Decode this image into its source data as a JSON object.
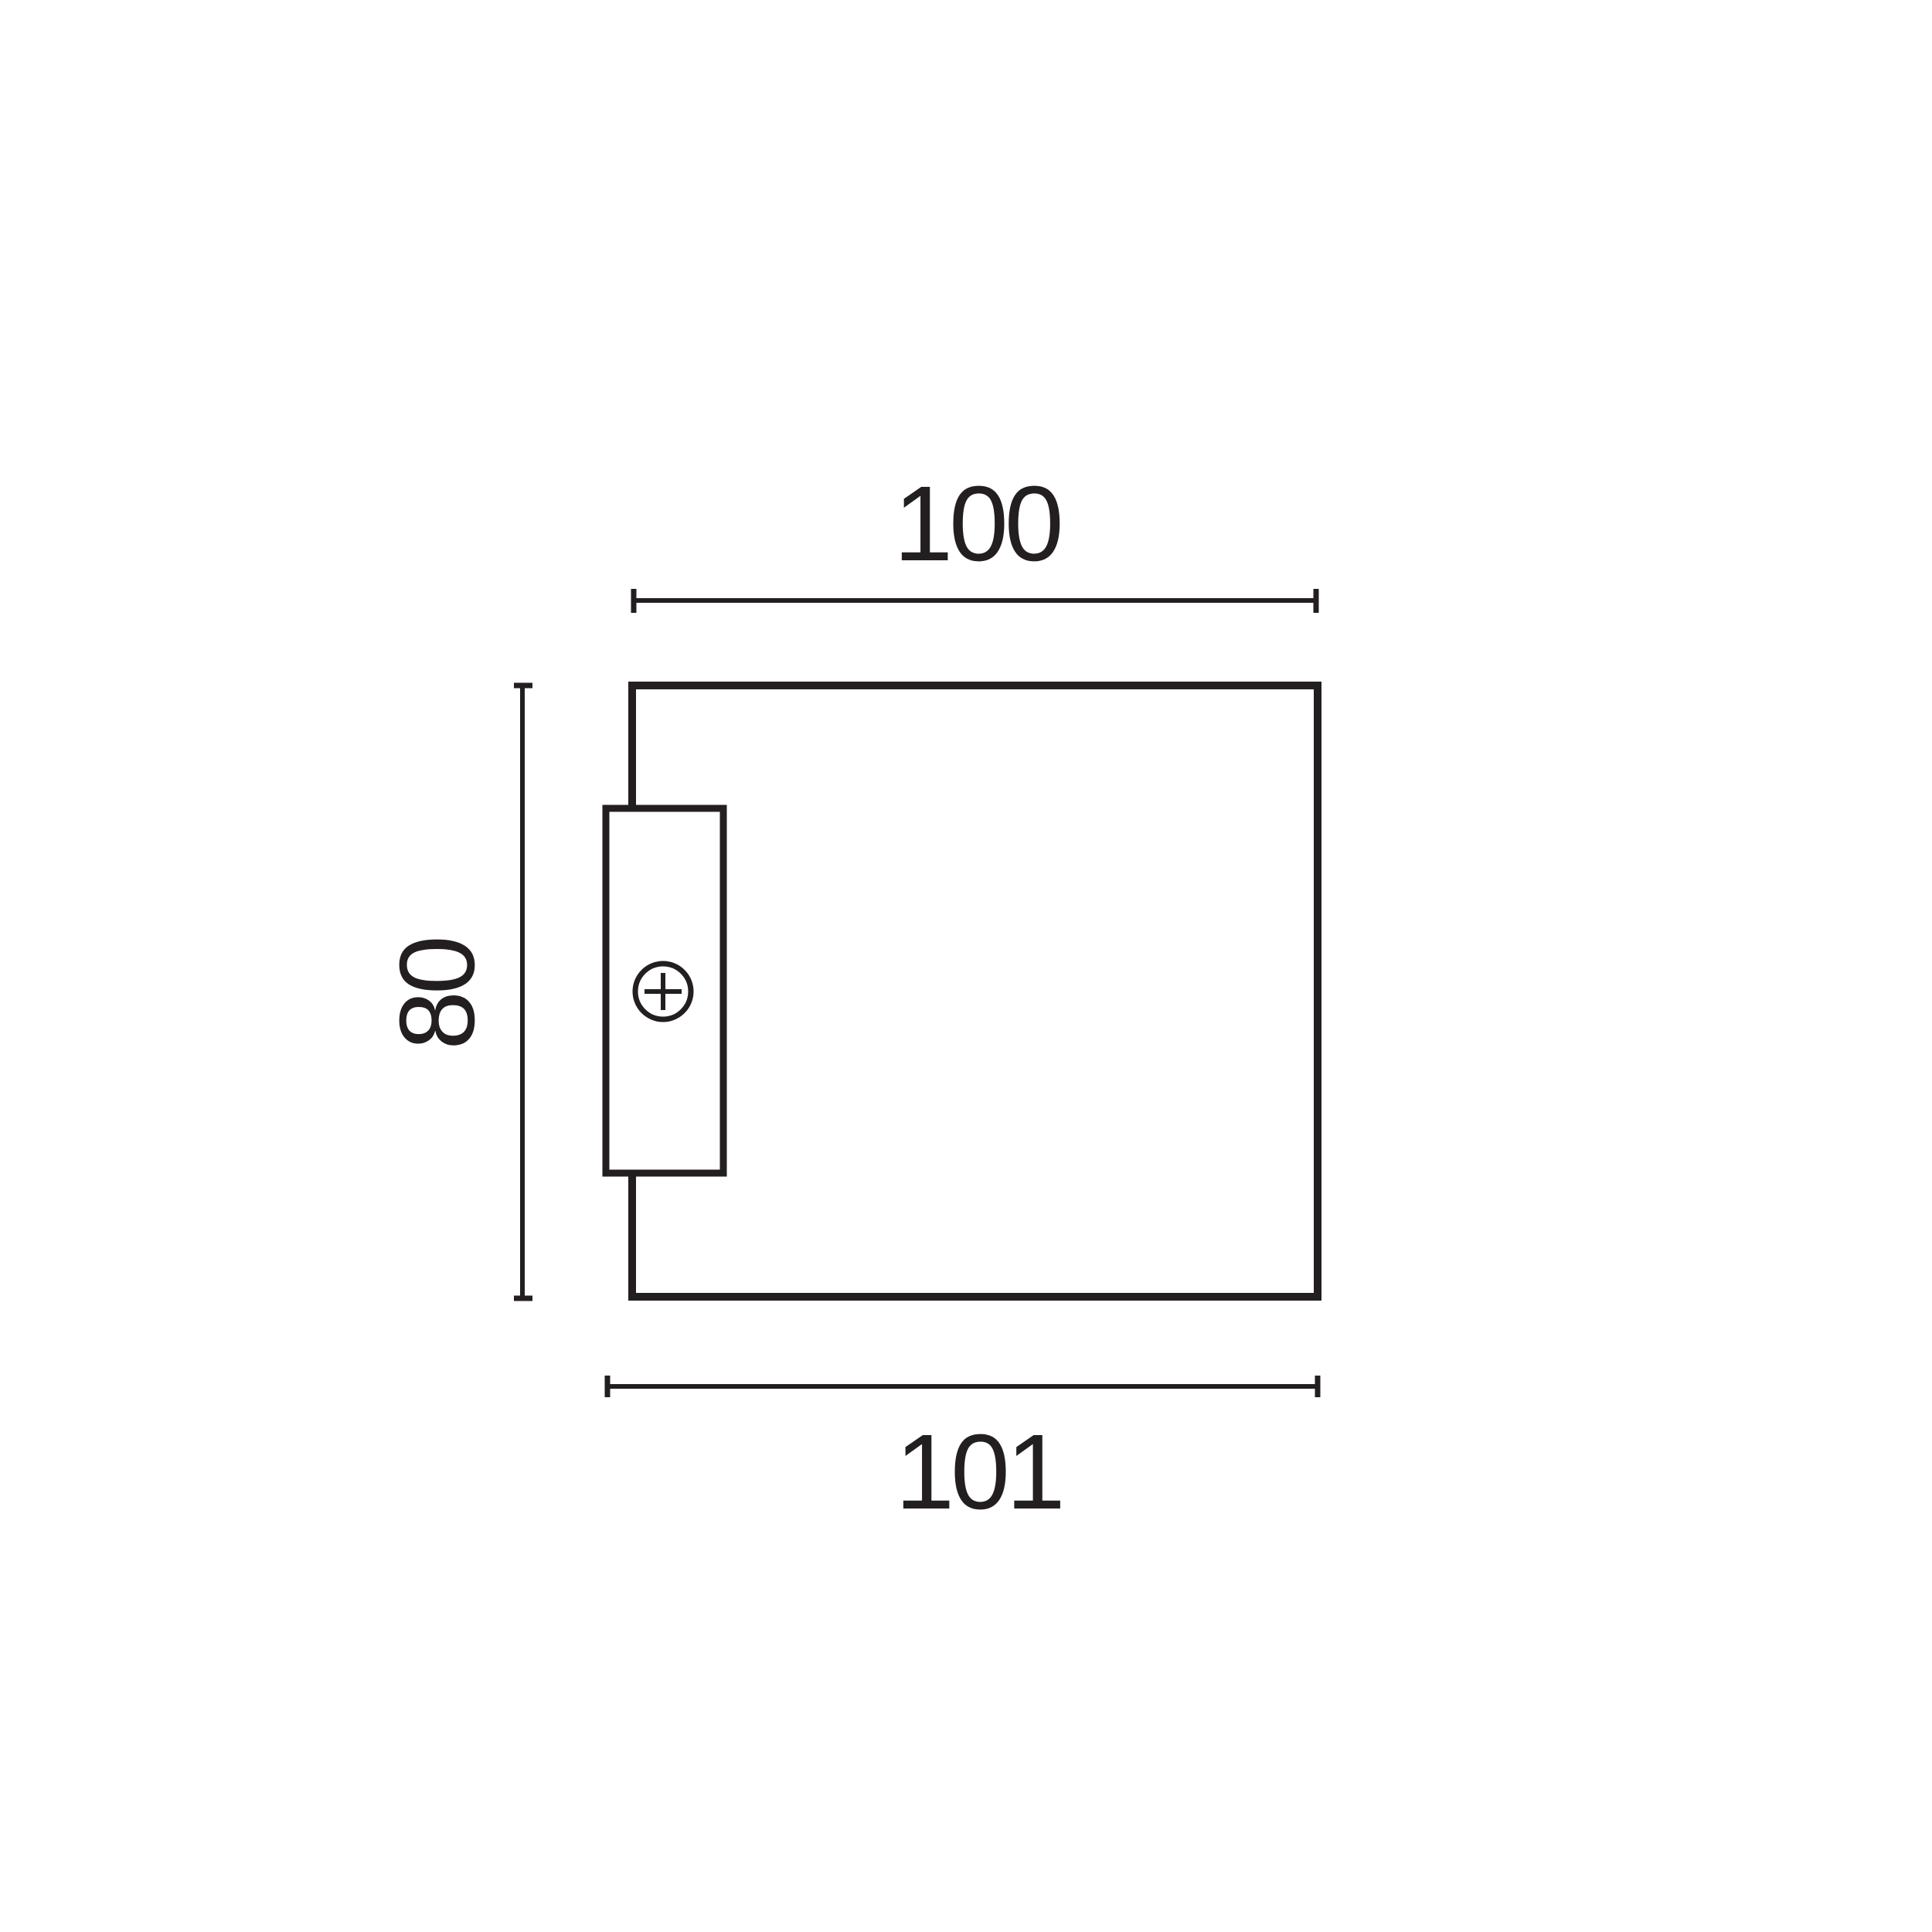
{
  "drawing": {
    "background_color": "#ffffff",
    "line_color": "#231f20",
    "dimensions": {
      "width_top": {
        "label": "100"
      },
      "height_left": {
        "label": "80"
      },
      "width_bottom": {
        "label": "101"
      }
    },
    "icons": {
      "screw": "circle-with-cross"
    }
  }
}
